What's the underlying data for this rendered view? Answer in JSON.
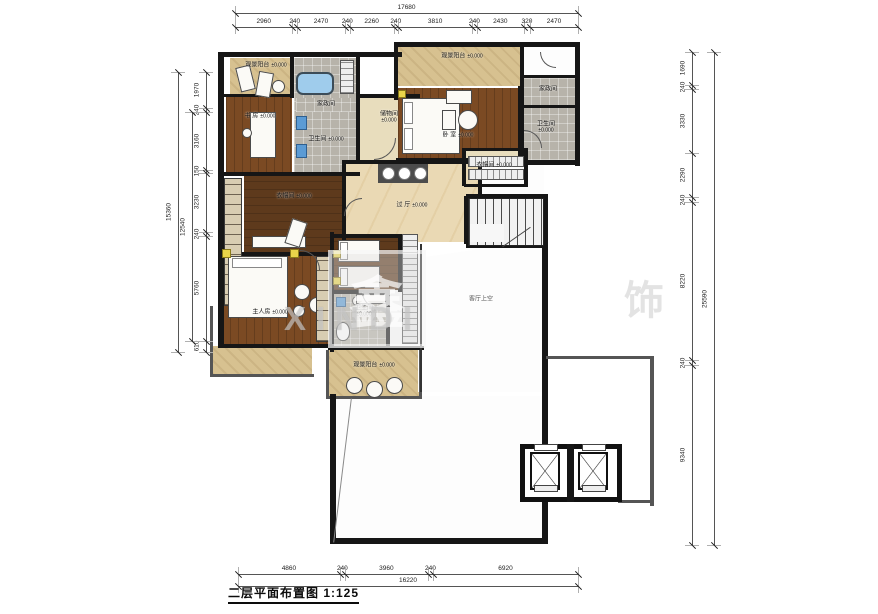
{
  "title": {
    "text": "二层平面布置图 1:125"
  },
  "watermark": {
    "logo_char": "鑫",
    "text": "XINDI",
    "right_char": "饰"
  },
  "dimensions": {
    "top": {
      "total": 17680,
      "segments": [
        2960,
        240,
        2470,
        240,
        2260,
        240,
        3810,
        240,
        2430,
        320,
        2470
      ],
      "from": 235,
      "to": 578,
      "line": 27,
      "total_line": 13
    },
    "bottom": {
      "total": 16220,
      "segments": [
        4860,
        240,
        3960,
        240,
        6920
      ],
      "from": 238,
      "to": 578,
      "line": 574,
      "total_line": 586
    },
    "left": {
      "total": 15360,
      "inner": 12540,
      "segments": [
        1970,
        240,
        3160,
        150,
        3230,
        240,
        5760,
        610
      ],
      "from": 72,
      "to": 352,
      "line": 206,
      "total_line": 178,
      "inner_line": 192,
      "inner_from": 112,
      "inner_to": 341
    },
    "right": {
      "total": 25590,
      "segments": [
        1690,
        240,
        3330,
        2290,
        240,
        8220,
        240,
        9340
      ],
      "from": 52,
      "to": 545,
      "line": 692,
      "total_line": 714
    }
  },
  "rooms": [
    {
      "id": "balcony-top-left",
      "label": "观景阳台",
      "elev": "±0.000",
      "x": 230,
      "y": 58,
      "w": 72,
      "h": 38,
      "floor": "tan",
      "lx": 266,
      "ly": 66
    },
    {
      "id": "study",
      "label": "书 房",
      "elev": "±0.000",
      "x": 226,
      "y": 96,
      "w": 66,
      "h": 78,
      "floor": "wood",
      "lx": 260,
      "ly": 117
    },
    {
      "id": "bath-top",
      "label": "卫生间",
      "elev": "±0.000",
      "x": 294,
      "y": 58,
      "w": 64,
      "h": 116,
      "floor": "gray",
      "lx": 326,
      "ly": 140
    },
    {
      "id": "laundry-top",
      "label": "家政间",
      "elev": "",
      "x": 296,
      "y": 98,
      "w": 60,
      "h": 14,
      "floor": "gray",
      "lx": 326,
      "ly": 105
    },
    {
      "id": "storage",
      "label": "储物间",
      "elev": "±0.000",
      "x": 358,
      "y": 98,
      "w": 62,
      "h": 62,
      "floor": "beige",
      "lx": 389,
      "ly": 118,
      "stack": 1
    },
    {
      "id": "bedroom-top-right",
      "label": "卧 室",
      "elev": "±0.000",
      "x": 398,
      "y": 88,
      "w": 122,
      "h": 72,
      "floor": "wood",
      "lx": 458,
      "ly": 136
    },
    {
      "id": "balcony-top-right",
      "label": "观景阳台",
      "elev": "±0.000",
      "x": 398,
      "y": 46,
      "w": 130,
      "h": 40,
      "floor": "tan",
      "lx": 462,
      "ly": 57
    },
    {
      "id": "corridor-top-right",
      "label": "",
      "elev": "",
      "x": 522,
      "y": 46,
      "w": 53,
      "h": 30,
      "floor": "white"
    },
    {
      "id": "laundry-right",
      "label": "家政间",
      "elev": "",
      "x": 522,
      "y": 78,
      "w": 53,
      "h": 28,
      "floor": "gray",
      "lx": 548,
      "ly": 90
    },
    {
      "id": "bath-top-right",
      "label": "卫生间",
      "elev": "±0.000",
      "x": 522,
      "y": 108,
      "w": 53,
      "h": 52,
      "floor": "gray",
      "lx": 546,
      "ly": 128,
      "stack": 1
    },
    {
      "id": "closet-right",
      "label": "衣帽间",
      "elev": "±0.000",
      "x": 466,
      "y": 151,
      "w": 58,
      "h": 34,
      "floor": "beige",
      "lx": 494,
      "ly": 166
    },
    {
      "id": "corridor-stairs",
      "label": "",
      "elev": "",
      "x": 480,
      "y": 164,
      "w": 64,
      "h": 32,
      "floor": "white"
    },
    {
      "id": "hall",
      "label": "过 厅",
      "elev": "±0.000",
      "x": 342,
      "y": 164,
      "w": 138,
      "h": 78,
      "floor": "marble",
      "lx": 412,
      "ly": 206
    },
    {
      "id": "cloak-center",
      "label": "衣帽间",
      "elev": "±0.000",
      "x": 244,
      "y": 176,
      "w": 98,
      "h": 78,
      "floor": "woodd",
      "lx": 294,
      "ly": 197
    },
    {
      "id": "master",
      "label": "主人房",
      "elev": "±0.000",
      "x": 222,
      "y": 256,
      "w": 108,
      "h": 88,
      "floor": "wood",
      "lx": 270,
      "ly": 313
    },
    {
      "id": "bedroom-middle",
      "label": "",
      "elev": "",
      "x": 332,
      "y": 236,
      "w": 68,
      "h": 54,
      "floor": "woodd"
    },
    {
      "id": "bath-bottom",
      "label": "卫生间",
      "elev": "±0.000",
      "x": 332,
      "y": 292,
      "w": 56,
      "h": 56,
      "floor": "gray",
      "lx": 364,
      "ly": 312,
      "stack": 1
    },
    {
      "id": "balcony-bottom",
      "label": "观景阳台",
      "elev": "±0.000",
      "x": 328,
      "y": 350,
      "w": 94,
      "h": 46,
      "floor": "tan",
      "lx": 374,
      "ly": 366
    },
    {
      "id": "balcony-bottom-left",
      "label": "",
      "elev": "",
      "x": 212,
      "y": 346,
      "w": 100,
      "h": 28,
      "floor": "tan"
    },
    {
      "id": "lower-room",
      "label": "",
      "elev": "",
      "x": 334,
      "y": 396,
      "w": 208,
      "h": 144,
      "floor": "white"
    }
  ],
  "void": {
    "label": "客厅上空",
    "x": 418,
    "y": 240,
    "w": 124,
    "h": 152,
    "lx": 481,
    "ly": 300
  },
  "walls": [
    [
      218,
      52,
      184,
      5
    ],
    [
      394,
      42,
      186,
      5
    ],
    [
      218,
      52,
      6,
      296
    ],
    [
      575,
      42,
      5,
      124
    ],
    [
      520,
      47,
      4,
      42
    ],
    [
      290,
      56,
      4,
      42
    ],
    [
      224,
      94,
      68,
      3
    ],
    [
      356,
      56,
      4,
      108
    ],
    [
      394,
      46,
      4,
      54
    ],
    [
      358,
      94,
      62,
      4
    ],
    [
      396,
      158,
      128,
      6
    ],
    [
      518,
      86,
      6,
      78
    ],
    [
      522,
      75,
      54,
      3
    ],
    [
      522,
      105,
      54,
      3
    ],
    [
      520,
      160,
      60,
      5
    ],
    [
      224,
      172,
      136,
      4
    ],
    [
      342,
      160,
      58,
      4
    ],
    [
      342,
      160,
      4,
      84
    ],
    [
      478,
      164,
      4,
      32
    ],
    [
      218,
      252,
      114,
      4
    ],
    [
      330,
      232,
      4,
      120
    ],
    [
      330,
      234,
      76,
      4
    ],
    [
      398,
      234,
      4,
      58
    ],
    [
      386,
      292,
      4,
      58
    ],
    [
      330,
      290,
      60,
      4
    ],
    [
      328,
      346,
      96,
      4
    ],
    [
      218,
      344,
      114,
      4
    ],
    [
      210,
      306,
      3,
      70,
      "#555"
    ],
    [
      210,
      374,
      104,
      3,
      "#555"
    ],
    [
      326,
      350,
      3,
      48,
      "#555"
    ],
    [
      419,
      350,
      3,
      48,
      "#555"
    ],
    [
      326,
      396,
      96,
      3,
      "#555"
    ],
    [
      420,
      244,
      2,
      148,
      "#333"
    ],
    [
      542,
      194,
      6,
      200
    ],
    [
      466,
      194,
      80,
      4
    ],
    [
      466,
      244,
      82,
      4
    ],
    [
      464,
      196,
      4,
      48
    ],
    [
      462,
      148,
      4,
      38
    ],
    [
      524,
      148,
      4,
      38
    ],
    [
      464,
      148,
      64,
      3
    ],
    [
      464,
      184,
      64,
      3
    ],
    [
      330,
      394,
      6,
      150
    ],
    [
      330,
      538,
      218,
      6
    ],
    [
      542,
      394,
      6,
      150
    ],
    [
      546,
      356,
      108,
      3,
      "#555"
    ],
    [
      650,
      356,
      4,
      150,
      "#555"
    ],
    [
      618,
      500,
      36,
      3,
      "#555"
    ]
  ],
  "furniture": [
    [
      "rect",
      238,
      66,
      15,
      25,
      -14
    ],
    [
      "rect",
      257,
      72,
      15,
      25,
      10
    ],
    [
      "circle",
      272,
      80,
      13,
      13
    ],
    [
      "rect",
      250,
      112,
      26,
      46
    ],
    [
      "circle",
      242,
      128,
      10,
      10
    ],
    [
      "tub",
      296,
      72,
      38,
      23
    ],
    [
      "shelfv",
      340,
      60,
      14,
      34
    ],
    [
      "blue",
      296,
      116,
      11,
      14
    ],
    [
      "blue",
      296,
      144,
      11,
      14
    ],
    [
      "rect",
      402,
      98,
      58,
      56
    ],
    [
      "pillow",
      404,
      102,
      9,
      22
    ],
    [
      "pillow",
      404,
      128,
      9,
      22
    ],
    [
      "yellow",
      398,
      90,
      8,
      8
    ],
    [
      "rect",
      446,
      90,
      26,
      14
    ],
    [
      "circle",
      458,
      110,
      20,
      20
    ],
    [
      "rect",
      442,
      110,
      14,
      20
    ],
    [
      "shelfh",
      468,
      156,
      56,
      11
    ],
    [
      "shelfh",
      468,
      169,
      56,
      11
    ],
    [
      "counter3",
      378,
      164,
      50,
      19
    ],
    [
      "wardrobe",
      224,
      178,
      18,
      128
    ],
    [
      "rect",
      252,
      236,
      54,
      12
    ],
    [
      "rect",
      288,
      220,
      16,
      26,
      18
    ],
    [
      "rect",
      228,
      256,
      60,
      62
    ],
    [
      "pillow",
      232,
      258,
      50,
      10
    ],
    [
      "yellow",
      222,
      249,
      9,
      9
    ],
    [
      "yellow",
      290,
      249,
      9,
      9
    ],
    [
      "circle",
      294,
      284,
      16,
      16
    ],
    [
      "circle",
      309,
      297,
      16,
      16
    ],
    [
      "circle",
      293,
      305,
      12,
      12
    ],
    [
      "wardrobe",
      316,
      256,
      14,
      86
    ],
    [
      "rect",
      338,
      240,
      42,
      22
    ],
    [
      "rect",
      338,
      266,
      42,
      22
    ],
    [
      "pillow",
      340,
      242,
      8,
      18
    ],
    [
      "pillow",
      340,
      268,
      8,
      18
    ],
    [
      "yellow",
      333,
      250,
      8,
      8
    ],
    [
      "yellow",
      333,
      277,
      8,
      8
    ],
    [
      "shelfv",
      402,
      234,
      16,
      110
    ],
    [
      "toilet",
      336,
      322,
      14,
      19
    ],
    [
      "circle",
      352,
      296,
      10,
      10
    ],
    [
      "blue",
      336,
      297,
      10,
      10
    ],
    [
      "rect",
      356,
      294,
      30,
      10
    ],
    [
      "circle",
      346,
      377,
      17,
      17
    ],
    [
      "circle",
      366,
      381,
      17,
      17
    ],
    [
      "circle",
      386,
      377,
      17,
      17
    ],
    [
      "diag",
      342,
      398,
      1,
      145,
      7
    ],
    [
      "arc",
      374,
      138,
      22,
      22,
      "br"
    ],
    [
      "arc",
      524,
      130,
      18,
      18,
      "tr"
    ],
    [
      "arc",
      540,
      52,
      16,
      16,
      "bl"
    ],
    [
      "arc",
      344,
      198,
      18,
      18,
      "tl"
    ],
    [
      "arc",
      300,
      250,
      20,
      20,
      "tr"
    ],
    [
      "arc",
      362,
      292,
      16,
      16,
      "bl"
    ]
  ],
  "stairs": {
    "x": 468,
    "y": 198,
    "w": 74,
    "h": 46,
    "landing": [
      470,
      224,
      34,
      18
    ],
    "rail": [
      516,
      220,
      1,
      34,
      55
    ]
  },
  "elevators": {
    "box": [
      520,
      444,
      102,
      58
    ],
    "divider": [
      567,
      444,
      7,
      58
    ],
    "cars": [
      [
        530,
        452,
        30,
        38
      ],
      [
        578,
        452,
        30,
        38
      ]
    ],
    "doors_top": [
      [
        534,
        444,
        22,
        5
      ],
      [
        582,
        444,
        22,
        5
      ]
    ],
    "doors_bot": [
      [
        534,
        485,
        22,
        5
      ],
      [
        582,
        485,
        22,
        5
      ]
    ]
  }
}
